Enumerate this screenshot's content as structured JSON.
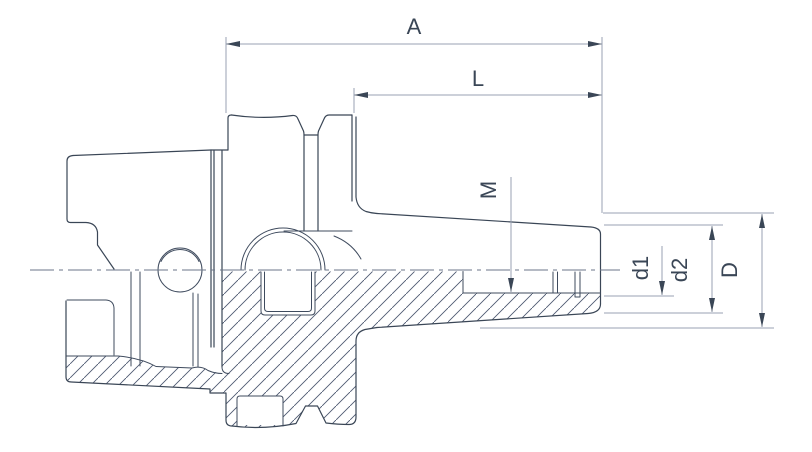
{
  "drawing": {
    "title": "Tool holder side view with half section",
    "background": "#ffffff",
    "colors": {
      "outline": "#3a4656",
      "interior": "#3f4b5e",
      "dimension": "#98a2b3",
      "arrow": "#3a4656",
      "text": "#3a4656",
      "hatch": "#4d5970",
      "centerline": "#6b7688"
    },
    "dimensions": [
      {
        "id": "A",
        "label": "A"
      },
      {
        "id": "L",
        "label": "L"
      },
      {
        "id": "M",
        "label": "M"
      },
      {
        "id": "d1",
        "label": "d1"
      },
      {
        "id": "d2",
        "label": "d2"
      },
      {
        "id": "D",
        "label": "D"
      }
    ]
  }
}
